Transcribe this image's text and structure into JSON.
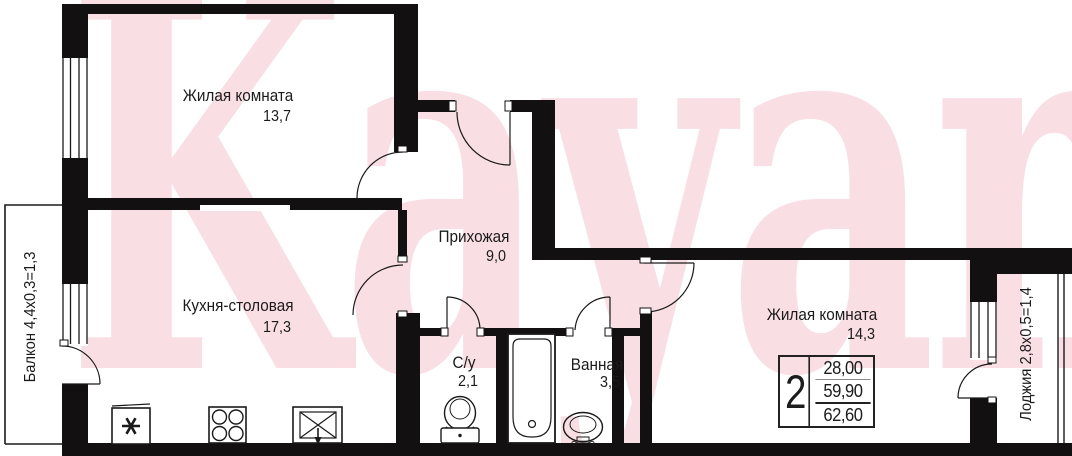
{
  "watermark": {
    "text": "Kayan"
  },
  "rooms": {
    "living1": {
      "name": "Жилая комната",
      "area": "13,7"
    },
    "kitchen": {
      "name": "Кухня-столовая",
      "area": "17,3"
    },
    "hallway": {
      "name": "Прихожая",
      "area": "9,0"
    },
    "wc": {
      "name": "С/у",
      "area": "2,1"
    },
    "bathroom": {
      "name": "Ванная",
      "area": "3,5"
    },
    "living2": {
      "name": "Жилая комната",
      "area": "14,3"
    }
  },
  "annotations": {
    "balcony": "Балкон 4,4х0,3=1,3",
    "loggia": "Лоджия 2,8х0,5=1,4"
  },
  "info_table": {
    "room_count": "2",
    "areas": [
      "28,00",
      "59,90",
      "62,60"
    ]
  },
  "icons": {
    "fridge": "six-point-asterisk",
    "stove": "four-burners",
    "kitchen_sink": "crossed-basin-with-tap",
    "toilet": "bowl-and-tank",
    "bathtub": "rounded-tub-with-drain",
    "washbasin": "oval-sink-with-faucet"
  },
  "colors": {
    "walls": "#121011",
    "lines": "#1a1a1a",
    "watermark": "#f7d3db"
  }
}
